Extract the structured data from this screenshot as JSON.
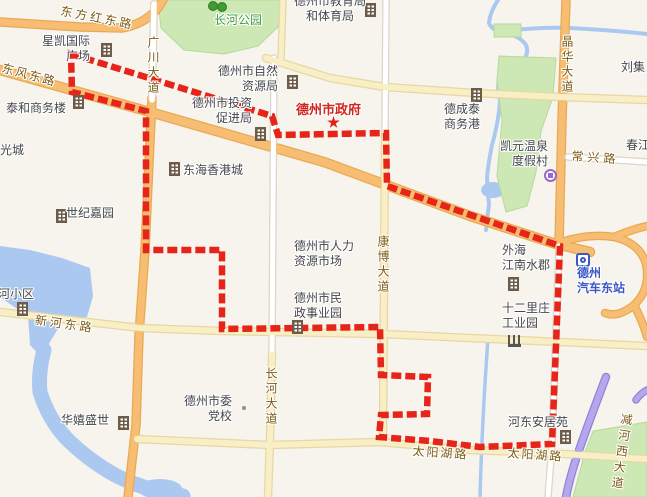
{
  "map": {
    "region_name": "德州市",
    "colors": {
      "background": "#f7f4ed",
      "water": "#abc9f0",
      "green": "#cde8b4",
      "green_border": "#b6d89a",
      "boundary_red": "#e7241a",
      "orange_fill": "#f7bd72",
      "orange_casing": "#e9a952",
      "yellow_fill": "#f9efc7",
      "yellow_casing": "#e6d7a3",
      "white_fill": "#ffffff",
      "white_casing": "#dcd6c8",
      "purple_fill": "#b4a7ee",
      "purple_casing": "#9183d6",
      "road_label": "#7d5a13",
      "place_label": "#45464b",
      "park_label": "#3f9c3f",
      "gov_label": "#cf2720",
      "transit_label": "#3b57c4"
    },
    "boundary": {
      "color": "#e7241a",
      "points": [
        [
          71,
          54
        ],
        [
          272,
          116
        ],
        [
          278,
          135
        ],
        [
          386,
          133
        ],
        [
          387,
          186
        ],
        [
          560,
          246
        ],
        [
          552,
          444
        ],
        [
          480,
          447
        ],
        [
          430,
          441
        ],
        [
          379,
          437
        ],
        [
          381,
          415
        ],
        [
          427,
          414
        ],
        [
          428,
          377
        ],
        [
          381,
          375
        ],
        [
          380,
          327
        ],
        [
          222,
          329
        ],
        [
          222,
          250
        ],
        [
          146,
          250
        ],
        [
          146,
          111
        ],
        [
          72,
          92
        ]
      ]
    },
    "water": {
      "lake_path": "M0,246 L30,250 L62,258 L90,268 L93,296 L87,317 L62,322 L50,342 L42,358 L30,345 L28,316 L10,304 L0,297 Z",
      "river_sw": "M44,350 Q38,372 40,392 Q48,418 66,438 Q88,460 115,475 Q140,488 165,492 Q175,494 183,496",
      "river_sw_width": 15,
      "river_ne": "M498,0 Q490,12 489,23 Q492,31 505,33 Q520,36 526,45 Q530,55 520,63 Q505,66 499,77 Q497,90 500,100 Q499,120 492,145 Q488,165 487,178 Q488,195 489,205 Q487,218 486,230",
      "river_ne_branch": "M505,31 Q540,27 570,28 Q610,30 647,34",
      "canal_se": "M488,338 Q485,380 483,420 Q481,460 480,497",
      "pond": {
        "cx": 493,
        "cy": 190,
        "rx": 12,
        "ry": 8
      },
      "mouth": {
        "cx": 160,
        "cy": 489,
        "rx": 22,
        "ry": 10
      }
    },
    "green_areas": [
      {
        "name": "changhe-park-area",
        "d": "M158,0 L281,0 L278,27 L258,46 L224,54 L184,50 L161,28 Z"
      },
      {
        "name": "small-green-ne",
        "d": "M494,24 L521,24 L521,37 L494,37 Z"
      },
      {
        "name": "east-park-area",
        "d": "M499,56 L556,58 L553,97 L541,131 L536,172 L527,206 L506,212 L497,176 L502,121 L497,80 Z"
      },
      {
        "name": "se-green-wedge",
        "d": "M593,431 L647,422 L647,497 L573,497 L585,452 Z"
      }
    ],
    "roads": [
      {
        "name": "dongfanghong-east-rd",
        "type": "orange",
        "w": 7,
        "d": "M0,22 L80,27 L122,28 Q145,24 158,8 L163,0"
      },
      {
        "name": "dongfeng-east-rd",
        "type": "orange",
        "w": 8,
        "d": "M0,70 L150,112 L324,162 L470,216 L556,244 L590,252"
      },
      {
        "name": "guangchuan-ave-south",
        "type": "orange",
        "w": 7,
        "d": "M152,98 L145,250 L139,335 L136,425 L128,497"
      },
      {
        "name": "jinghua-ave",
        "type": "orange",
        "w": 7,
        "d": "M566,0 L562,120 L559,244"
      },
      {
        "name": "interchange-loop",
        "type": "orange",
        "w": 6,
        "d": "M556,244 Q586,233 614,237 Q640,243 646,264 Q651,289 634,305 Q618,318 605,313"
      },
      {
        "name": "interchange-ne-ramp",
        "type": "orange",
        "w": 6,
        "d": "M614,237 Q630,230 647,226"
      },
      {
        "name": "interchange-s-ramp",
        "type": "orange",
        "w": 6,
        "d": "M634,305 Q643,322 647,337"
      },
      {
        "name": "minor-north-rd",
        "type": "yellow",
        "w": 5,
        "d": "M283,0 L281,60"
      },
      {
        "name": "jianhe-west-ave",
        "type": "purple",
        "w": 6,
        "d": "M606,377 Q588,424 576,459 Q569,481 566,497"
      },
      {
        "name": "jianhe-west-ave-stub",
        "type": "purple",
        "w": 5,
        "d": "M647,390 Q640,394 636,400"
      },
      {
        "name": "guangchuan-ave-north",
        "type": "white",
        "w": 5.5,
        "d": "M154,4 L152,100"
      },
      {
        "name": "changxing-rd",
        "type": "white",
        "w": 5,
        "d": "M568,157 L647,162"
      },
      {
        "name": "east-station-rd",
        "type": "white",
        "w": 5,
        "d": "M559,246 L552,445 L548,497"
      },
      {
        "name": "kangbo-ave-north",
        "type": "white",
        "w": 5,
        "d": "M386,0 L385,135"
      },
      {
        "name": "changhe-ave-north",
        "type": "white",
        "w": 5,
        "d": "M274,58 L272,355"
      },
      {
        "name": "north-cross-rd",
        "type": "yellow",
        "w": 6,
        "d": "M266,58 L330,78 L385,87 L475,93 L560,97 L647,100"
      },
      {
        "name": "kangbo-ave-south",
        "type": "yellow",
        "w": 6,
        "d": "M385,135 L383,440"
      },
      {
        "name": "changhe-ave-south",
        "type": "yellow",
        "w": 6,
        "d": "M272,355 L270,440 L268,497"
      },
      {
        "name": "xinhe-east-rd",
        "type": "yellow",
        "w": 6,
        "d": "M0,312 L140,328 L222,331 L383,334 L470,338 L560,342 L647,346"
      },
      {
        "name": "taiyanghu-rd",
        "type": "yellow",
        "w": 6,
        "d": "M137,439 L270,445 L380,442 L470,450 L548,453 L647,459"
      }
    ],
    "road_labels": [
      {
        "id": "dongfanghong",
        "text": "东方红东路",
        "x": 62,
        "y": 4,
        "rotate": 11,
        "spacing": 3
      },
      {
        "id": "dongfeng",
        "text": "东风东路",
        "x": 4,
        "y": 61,
        "rotate": 15,
        "spacing": 2
      },
      {
        "id": "guangchuan",
        "text": "广川大道",
        "x": 145,
        "y": 36,
        "vertical": true,
        "spacing": 3
      },
      {
        "id": "jinghua",
        "text": "晶华大道",
        "x": 559,
        "y": 35,
        "vertical": true,
        "spacing": 3
      },
      {
        "id": "kangbo",
        "text": "康博大道",
        "x": 375,
        "y": 235,
        "vertical": true,
        "spacing": 3
      },
      {
        "id": "changhe",
        "text": "长河大道",
        "x": 263,
        "y": 367,
        "vertical": true,
        "spacing": 3
      },
      {
        "id": "changxing",
        "text": "常兴路",
        "x": 572,
        "y": 149,
        "rotate": 4,
        "spacing": 4
      },
      {
        "id": "xinhe",
        "text": "新河东路",
        "x": 36,
        "y": 313,
        "rotate": 8,
        "spacing": 3
      },
      {
        "id": "taiyanghu-west",
        "text": "太阳湖路",
        "x": 413,
        "y": 444,
        "rotate": 4,
        "spacing": 2
      },
      {
        "id": "taiyanghu-east",
        "text": "太阳湖路",
        "x": 508,
        "y": 446,
        "rotate": 4,
        "spacing": 2
      },
      {
        "id": "jianhe-west",
        "text": "减河西大道",
        "x": 619,
        "y": 412,
        "vertical": true,
        "rotate": 8,
        "spacing": 4
      }
    ],
    "place_labels": [
      {
        "id": "changhe-park",
        "lines": [
          "长河公园"
        ],
        "x": 214,
        "y": 13,
        "cls": "park"
      },
      {
        "id": "xingkai-international-plaza",
        "lines": [
          "星凯国际",
          "广场"
        ],
        "x": 42,
        "y": 34,
        "align": "right",
        "cls": "place"
      },
      {
        "id": "taihe-business-building",
        "lines": [
          "泰和商务楼"
        ],
        "x": 6,
        "y": 101,
        "cls": "place"
      },
      {
        "id": "yangguangcheng",
        "lines": [
          "阳光城"
        ],
        "x": -12,
        "y": 143,
        "cls": "place"
      },
      {
        "id": "natural-resources-bureau",
        "lines": [
          "德州市自然",
          "资源局"
        ],
        "x": 218,
        "y": 64,
        "align": "right",
        "cls": "place"
      },
      {
        "id": "investment-promotion-bureau",
        "lines": [
          "德州市投资",
          "促进局"
        ],
        "x": 192,
        "y": 96,
        "align": "right",
        "cls": "place"
      },
      {
        "id": "education-sports-bureau",
        "lines": [
          "德州市教育局",
          "和体育局"
        ],
        "x": 294,
        "y": -6,
        "align": "center",
        "cls": "place"
      },
      {
        "id": "dezhou-city-government",
        "lines": [
          "德州市政府"
        ],
        "x": 296,
        "y": 102,
        "cls": "gov"
      },
      {
        "id": "donghai-hongkong-city",
        "lines": [
          "东海香港城"
        ],
        "x": 183,
        "y": 163,
        "cls": "place"
      },
      {
        "id": "shiji-jiayuan",
        "lines": [
          "世纪嘉园"
        ],
        "x": 66,
        "y": 206,
        "cls": "place"
      },
      {
        "id": "dechengtai-business-port",
        "lines": [
          "德成泰",
          "商务港"
        ],
        "x": 444,
        "y": 102,
        "align": "left",
        "cls": "place"
      },
      {
        "id": "kaiyuan-hotspring-resort",
        "lines": [
          "凯元温泉",
          "度假村"
        ],
        "x": 500,
        "y": 139,
        "align": "right",
        "cls": "place"
      },
      {
        "id": "liuji",
        "lines": [
          "刘集"
        ],
        "x": 621,
        "y": 60,
        "cls": "place"
      },
      {
        "id": "chunjiang",
        "lines": [
          "春江"
        ],
        "x": 626,
        "y": 138,
        "cls": "place"
      },
      {
        "id": "human-resources-market",
        "lines": [
          "德州市人力",
          "资源市场"
        ],
        "x": 294,
        "y": 239,
        "align": "left",
        "cls": "place"
      },
      {
        "id": "civil-affairs-park",
        "lines": [
          "德州市民",
          "政事业园"
        ],
        "x": 294,
        "y": 291,
        "align": "left",
        "cls": "place"
      },
      {
        "id": "waihai-jiangnan",
        "lines": [
          "外海",
          "江南水郡"
        ],
        "x": 502,
        "y": 243,
        "align": "left",
        "cls": "place"
      },
      {
        "id": "shierlizhuang-industrial-park",
        "lines": [
          "十二里庄",
          "工业园"
        ],
        "x": 502,
        "y": 301,
        "align": "left",
        "cls": "place"
      },
      {
        "id": "dezhou-east-bus-station",
        "lines": [
          "德州",
          "汽车东站"
        ],
        "x": 577,
        "y": 266,
        "align": "left",
        "cls": "transit"
      },
      {
        "id": "xinhe-residential",
        "lines": [
          "新河小区"
        ],
        "x": -14,
        "y": 287,
        "cls": "place"
      },
      {
        "id": "huaxi-shengshi",
        "lines": [
          "华嬉盛世"
        ],
        "x": 61,
        "y": 413,
        "cls": "place"
      },
      {
        "id": "party-school",
        "lines": [
          "德州市委",
          "党校"
        ],
        "x": 184,
        "y": 394,
        "align": "right",
        "cls": "place"
      },
      {
        "id": "hedong-anjuyuan",
        "lines": [
          "河东安居苑"
        ],
        "x": 508,
        "y": 415,
        "cls": "place"
      }
    ],
    "icons": [
      {
        "type": "building",
        "name": "xingkai-building-icon",
        "x": 101,
        "y": 43
      },
      {
        "type": "building",
        "name": "taihe-building-icon",
        "x": 73,
        "y": 95
      },
      {
        "type": "building",
        "name": "ziranziyuan-building-icon",
        "x": 287,
        "y": 75
      },
      {
        "type": "building",
        "name": "cujinju-building-icon",
        "x": 255,
        "y": 127
      },
      {
        "type": "building",
        "name": "jiaoyuju-building-icon",
        "x": 365,
        "y": 3
      },
      {
        "type": "building",
        "name": "dechengtai-building-icon",
        "x": 471,
        "y": 88
      },
      {
        "type": "building",
        "name": "shijijiayuan-building-icon",
        "x": 56,
        "y": 209
      },
      {
        "type": "building",
        "name": "donghai-building-icon",
        "x": 169,
        "y": 162
      },
      {
        "type": "building",
        "name": "xinhexiaoqu-building-icon",
        "x": 17,
        "y": 302
      },
      {
        "type": "building",
        "name": "huaxi-building-icon",
        "x": 118,
        "y": 416
      },
      {
        "type": "building",
        "name": "minzheng-building-icon",
        "x": 292,
        "y": 320
      },
      {
        "type": "building",
        "name": "waihai-building-icon",
        "x": 508,
        "y": 277
      },
      {
        "type": "building",
        "name": "hedong-building-icon",
        "x": 560,
        "y": 430
      },
      {
        "type": "factory",
        "name": "industrial-park-factory-icon",
        "x": 508,
        "y": 335
      },
      {
        "type": "tree",
        "name": "park-tree-icon",
        "x": 208,
        "y": 1
      },
      {
        "type": "tree",
        "name": "park-tree-icon",
        "x": 217,
        "y": 2
      },
      {
        "type": "star",
        "name": "city-government-star-icon",
        "x": 327,
        "y": 116
      },
      {
        "type": "bus",
        "name": "bus-station-icon",
        "x": 576,
        "y": 253
      },
      {
        "type": "spring",
        "name": "hotspring-resort-icon",
        "x": 544,
        "y": 169
      },
      {
        "type": "dot",
        "name": "poi-dot",
        "x": 242,
        "y": 406
      }
    ]
  }
}
